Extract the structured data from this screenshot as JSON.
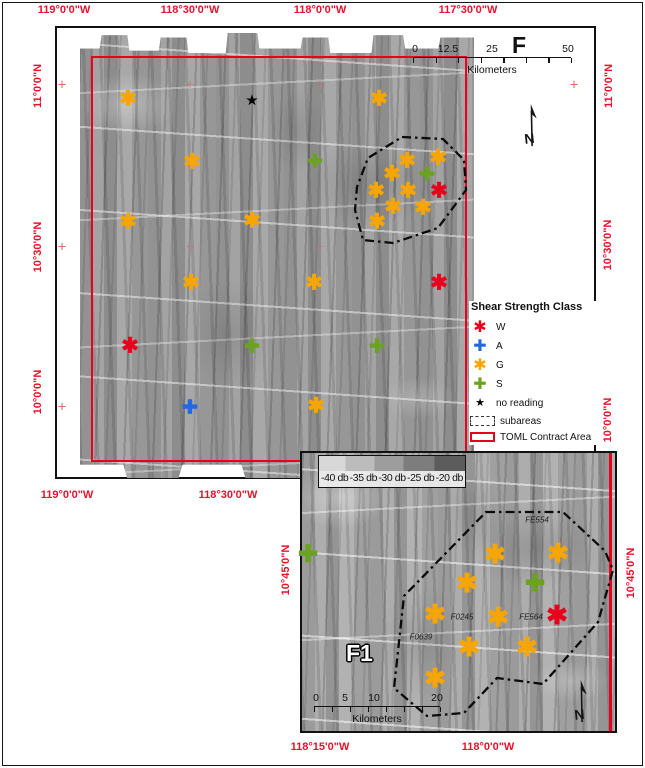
{
  "colors": {
    "W": "#e8001c",
    "A": "#2468dd",
    "G": "#f7a500",
    "S": "#6ba321",
    "star": "#000000",
    "map_red": "#e8001c",
    "label_red": "#e8122c"
  },
  "figure": {
    "main_label": "F",
    "inset_label": "F1"
  },
  "geo_labels": [
    {
      "text": "119°0'0\"W",
      "x": 64,
      "y": 10,
      "rot": false
    },
    {
      "text": "118°30'0\"W",
      "x": 190,
      "y": 10,
      "rot": false
    },
    {
      "text": "118°0'0\"W",
      "x": 320,
      "y": 10,
      "rot": false
    },
    {
      "text": "117°30'0\"W",
      "x": 468,
      "y": 10,
      "rot": false
    },
    {
      "text": "119°0'0\"W",
      "x": 67,
      "y": 495,
      "rot": false
    },
    {
      "text": "118°30'0\"W",
      "x": 228,
      "y": 495,
      "rot": false
    },
    {
      "text": "11°0'0\"N",
      "x": 38,
      "y": 86,
      "rot": true
    },
    {
      "text": "10°30'0\"N",
      "x": 38,
      "y": 247,
      "rot": true
    },
    {
      "text": "10°0'0\"N",
      "x": 38,
      "y": 392,
      "rot": true
    },
    {
      "text": "11°0'0\"N",
      "x": 609,
      "y": 86,
      "rot": true
    },
    {
      "text": "10°30'0\"N",
      "x": 608,
      "y": 245,
      "rot": true
    },
    {
      "text": "10°0'0\"N",
      "x": 608,
      "y": 420,
      "rot": true
    },
    {
      "text": "10°45'0\"N",
      "x": 286,
      "y": 570,
      "rot": true
    },
    {
      "text": "10°45'0\"N",
      "x": 631,
      "y": 573,
      "rot": true
    },
    {
      "text": "118°15'0\"W",
      "x": 320,
      "y": 747,
      "rot": false
    },
    {
      "text": "118°0'0\"W",
      "x": 488,
      "y": 747,
      "rot": false
    }
  ],
  "main_map": {
    "scalebar": {
      "x": 413,
      "y": 43,
      "width": 158,
      "unit": "Kilometers",
      "tick_labels": [
        {
          "text": "0",
          "dx": 2
        },
        {
          "text": "12.5",
          "dx": 35
        },
        {
          "text": "25",
          "dx": 79
        },
        {
          "text": "50",
          "dx": 155
        }
      ]
    },
    "polygon": "402,137 443,139 464,160 466,190 438,228 393,243 363,240 355,210 357,187 368,158",
    "crosses": [
      [
        62,
        85,
        0.9
      ],
      [
        62,
        247,
        0.9
      ],
      [
        62,
        407,
        0.9
      ],
      [
        574,
        85,
        0.9
      ],
      [
        190,
        85,
        0.4
      ],
      [
        320,
        85,
        0.4
      ],
      [
        190,
        247,
        0.4
      ],
      [
        320,
        247,
        0.4
      ],
      [
        190,
        407,
        0.4
      ],
      [
        320,
        407,
        0.4
      ]
    ],
    "markers": [
      {
        "type": "G",
        "x": 128,
        "y": 99
      },
      {
        "type": "star",
        "x": 252,
        "y": 100
      },
      {
        "type": "G",
        "x": 379,
        "y": 99
      },
      {
        "type": "G",
        "x": 192,
        "y": 162
      },
      {
        "type": "S",
        "x": 315,
        "y": 162
      },
      {
        "type": "G",
        "x": 407,
        "y": 161
      },
      {
        "type": "G",
        "x": 438,
        "y": 158
      },
      {
        "type": "G",
        "x": 392,
        "y": 174
      },
      {
        "type": "S",
        "x": 427,
        "y": 175
      },
      {
        "type": "G",
        "x": 376,
        "y": 191
      },
      {
        "type": "G",
        "x": 408,
        "y": 191
      },
      {
        "type": "W",
        "x": 439,
        "y": 191
      },
      {
        "type": "G",
        "x": 393,
        "y": 207
      },
      {
        "type": "G",
        "x": 423,
        "y": 208
      },
      {
        "type": "G",
        "x": 377,
        "y": 222
      },
      {
        "type": "G",
        "x": 128,
        "y": 222
      },
      {
        "type": "G",
        "x": 252,
        "y": 221
      },
      {
        "type": "G",
        "x": 191,
        "y": 283
      },
      {
        "type": "G",
        "x": 314,
        "y": 283
      },
      {
        "type": "W",
        "x": 439,
        "y": 283
      },
      {
        "type": "W",
        "x": 130,
        "y": 346
      },
      {
        "type": "S",
        "x": 252,
        "y": 347
      },
      {
        "type": "S",
        "x": 377,
        "y": 347
      },
      {
        "type": "A",
        "x": 190,
        "y": 408
      },
      {
        "type": "G",
        "x": 316,
        "y": 406
      }
    ]
  },
  "legend": {
    "title": "Shear Strength Class",
    "items": [
      {
        "type": "W",
        "label": "W"
      },
      {
        "type": "A",
        "label": "A"
      },
      {
        "type": "G",
        "label": "G"
      },
      {
        "type": "S",
        "label": "S"
      },
      {
        "type": "star",
        "label": "no reading"
      }
    ],
    "swatches": [
      {
        "kind": "subareas",
        "label": "subareas"
      },
      {
        "kind": "toml",
        "label": "TOML Contract Area"
      }
    ]
  },
  "inset": {
    "db_labels": [
      "-40 db",
      "-35 db",
      "-30 db",
      "-25 db",
      "-20 db"
    ],
    "scalebar": {
      "x": 314,
      "y": 692,
      "width": 126,
      "unit": "Kilometers",
      "tick_labels": [
        {
          "text": "0",
          "dx": 2
        },
        {
          "text": "5",
          "dx": 31
        },
        {
          "text": "10",
          "dx": 60
        },
        {
          "text": "20",
          "dx": 123
        }
      ]
    },
    "polygon": "486,512 563,512 605,551 613,570 598,622 543,684 497,678 464,713 427,716 394,688 404,596",
    "site_labels": [
      {
        "text": "FE554",
        "x": 537,
        "y": 520
      },
      {
        "text": "F0245",
        "x": 462,
        "y": 617
      },
      {
        "text": "FE564",
        "x": 531,
        "y": 617
      },
      {
        "text": "F0639",
        "x": 421,
        "y": 637
      }
    ],
    "markers": [
      {
        "type": "S",
        "x": 308,
        "y": 555
      },
      {
        "type": "G",
        "x": 495,
        "y": 554
      },
      {
        "type": "G",
        "x": 558,
        "y": 553
      },
      {
        "type": "G",
        "x": 467,
        "y": 583
      },
      {
        "type": "S",
        "x": 535,
        "y": 584
      },
      {
        "type": "G",
        "x": 435,
        "y": 614
      },
      {
        "type": "G",
        "x": 498,
        "y": 617
      },
      {
        "type": "W",
        "x": 557,
        "y": 615
      },
      {
        "type": "G",
        "x": 469,
        "y": 647
      },
      {
        "type": "G",
        "x": 527,
        "y": 647
      },
      {
        "type": "G",
        "x": 435,
        "y": 678
      }
    ]
  }
}
